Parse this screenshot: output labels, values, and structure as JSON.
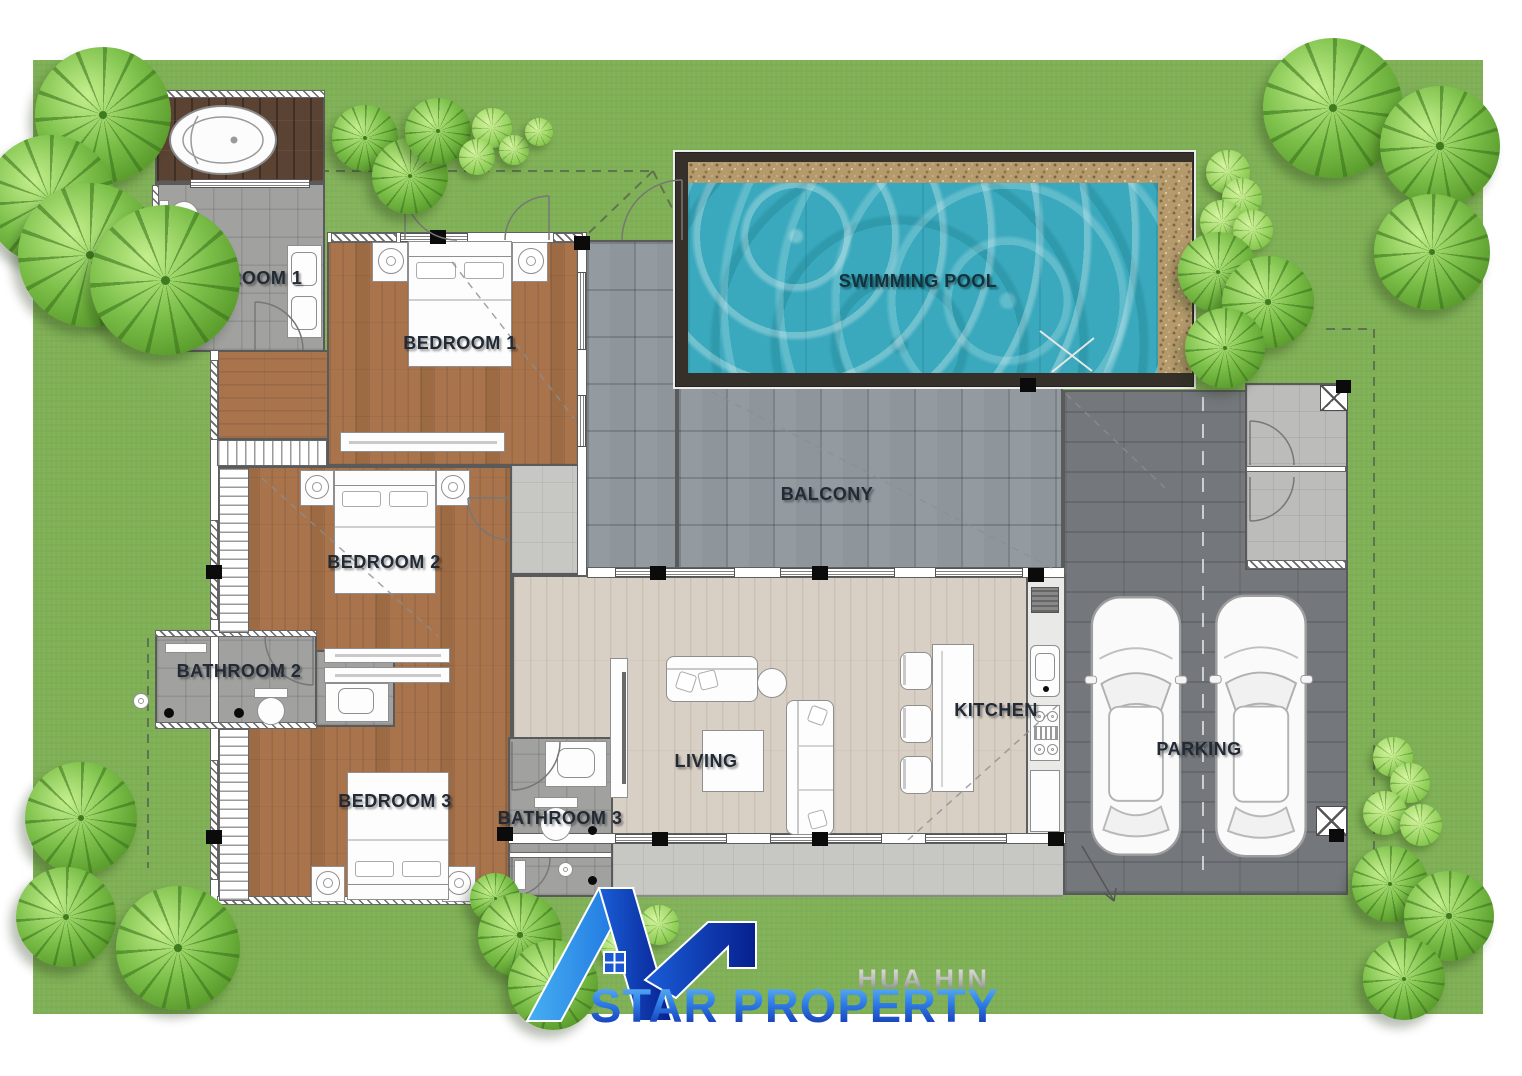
{
  "branding": {
    "location": "HUA HIN",
    "company": "STAR PROPERTY"
  },
  "floorplan": {
    "rooms": [
      {
        "id": "bathroom-1",
        "label": "BATHROOM 1"
      },
      {
        "id": "bedroom-1",
        "label": "BEDROOM 1"
      },
      {
        "id": "swimming-pool",
        "label": "SWIMMING POOL"
      },
      {
        "id": "balcony",
        "label": "BALCONY"
      },
      {
        "id": "bedroom-2",
        "label": "BEDROOM 2"
      },
      {
        "id": "bathroom-2",
        "label": "BATHROOM 2"
      },
      {
        "id": "living",
        "label": "LIVING"
      },
      {
        "id": "kitchen",
        "label": "KITCHEN"
      },
      {
        "id": "bedroom-3",
        "label": "BEDROOM 3"
      },
      {
        "id": "bathroom-3",
        "label": "BATHROOM 3"
      },
      {
        "id": "parking",
        "label": "PARKING"
      }
    ],
    "cars_in_parking": 2
  },
  "colors": {
    "lawn": "#7fb055",
    "pool_water": "#3aa9bd",
    "pool_pebble": "#b49a6d",
    "pool_frame": "#35302a",
    "bedroom_wood": "#a9744b",
    "deck_wood": "#5b4333",
    "living_floor": "#d8cfc5",
    "bathroom_tile": "#a1a19f",
    "balcony_tile": "#8e969b",
    "parking_tile": "#74787c",
    "label_text": "#222a35",
    "logo_light_blue": "#47b0f2",
    "logo_blue": "#1d6fe0",
    "logo_dark_blue": "#0b2fa8",
    "logo_silver": "#a8a8a8"
  },
  "icons": {
    "palm-tree": "green radial-leaf disc",
    "shrub": "small green radial-leaf disc",
    "car": "white top-view car",
    "bathtub": "white oval tub",
    "logo-house": "blue roof mark with window"
  }
}
